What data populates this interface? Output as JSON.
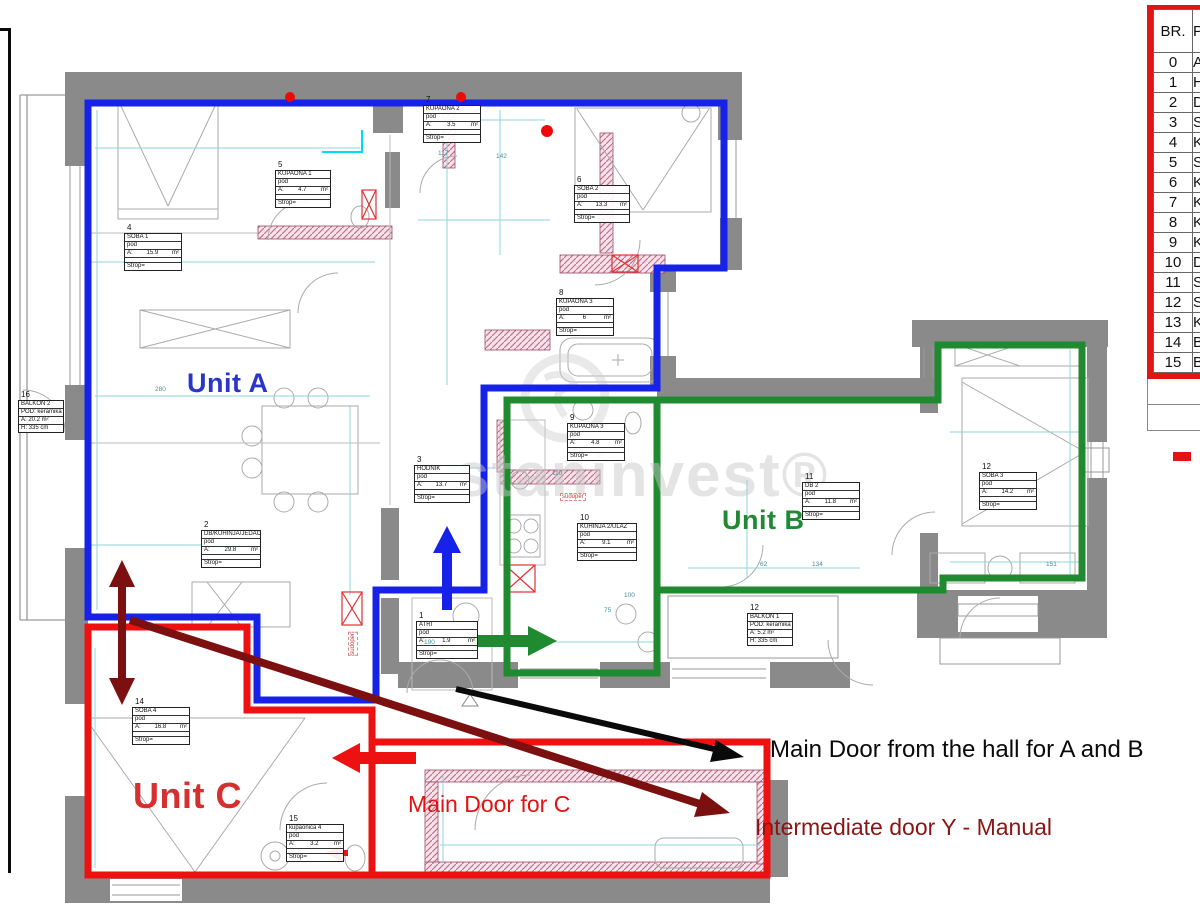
{
  "annotations": {
    "unit_a": "Unit A",
    "unit_b": "Unit B",
    "unit_c": "Unit C",
    "main_door_ab": "Main Door from the hall for A and B",
    "main_door_c": "Main Door for C",
    "intermediate_door": "Intermediate door Y - Manual"
  },
  "watermark": "staninvest®",
  "colors": {
    "unit_a_outline": "#1722e8",
    "unit_b_outline": "#1f8a2f",
    "unit_c_outline": "#ee1111",
    "unit_a_text": "#2a35c9",
    "unit_b_text": "#1f8a33",
    "unit_c_text": "#d53030",
    "main_door_c_text": "#e31212",
    "intermediate_text": "#8b1515",
    "maroon_arrow": "#7c1010",
    "wall_gray": "#8a8a8a"
  },
  "plan": {
    "rooms": [
      {
        "num": "1",
        "title": "ATRI",
        "pod": "pod",
        "area": "1.9",
        "strop": "Strop=",
        "x": 416,
        "y": 612,
        "w": 62
      },
      {
        "num": "2",
        "title": "DB/KUHINJA/JEDAĆA",
        "pod": "pod",
        "area": "29.8",
        "strop": "Strop=",
        "x": 201,
        "y": 521,
        "w": 60
      },
      {
        "num": "3",
        "title": "HODNIK",
        "pod": "pod",
        "area": "13.7",
        "strop": "Strop=",
        "x": 414,
        "y": 456,
        "w": 56
      },
      {
        "num": "4",
        "title": "SOBA 1",
        "pod": "pod",
        "area": "15.9",
        "strop": "Strop=",
        "x": 124,
        "y": 224,
        "w": 58
      },
      {
        "num": "5",
        "title": "KUPAONA 1",
        "pod": "pod",
        "area": "4.7",
        "strop": "Strop=",
        "x": 275,
        "y": 161,
        "w": 56
      },
      {
        "num": "6",
        "title": "SOBA 2",
        "pod": "pod",
        "area": "13.3",
        "strop": "Strop=",
        "x": 574,
        "y": 176,
        "w": 56
      },
      {
        "num": "7",
        "title": "KUPAONA 2",
        "pod": "pod",
        "area": "3.5",
        "strop": "Strop=",
        "x": 423,
        "y": 96,
        "w": 58
      },
      {
        "num": "8",
        "title": "KUPAONA 3",
        "pod": "pod",
        "area": "6",
        "strop": "Strop=",
        "x": 556,
        "y": 289,
        "w": 58
      },
      {
        "num": "9",
        "title": "KUPAONA 3",
        "pod": "pod",
        "area": "4.8",
        "strop": "Strop=",
        "x": 567,
        "y": 414,
        "w": 58
      },
      {
        "num": "10",
        "title": "KUHINJA 2/ULAZ",
        "pod": "pod",
        "area": "9.1",
        "strop": "Strop=",
        "x": 577,
        "y": 514,
        "w": 60
      },
      {
        "num": "11",
        "title": "DB 2",
        "pod": "pod",
        "area": "11.8",
        "strop": "Strop=",
        "x": 802,
        "y": 473,
        "w": 58
      },
      {
        "num": "12",
        "title": "SOBA 3",
        "pod": "pod",
        "area": "14.2",
        "strop": "Strop=",
        "x": 979,
        "y": 463,
        "w": 58
      },
      {
        "num": "14",
        "title": "SOBA 4",
        "pod": "pod",
        "area": "16.8",
        "strop": "Strop=",
        "x": 132,
        "y": 698,
        "w": 58
      },
      {
        "num": "15",
        "title": "kupaonica 4",
        "pod": "pod",
        "area": "3.2",
        "strop": "Strop=",
        "x": 286,
        "y": 815,
        "w": 58
      }
    ],
    "balconies": [
      {
        "num": "16",
        "title": "BALKON 2",
        "rows": [
          "POD: keramika",
          "A: 20.2  m²",
          "H: 335  cm"
        ],
        "x": 18,
        "y": 391,
        "w": 46
      },
      {
        "num": "12",
        "title": "BALKON 1",
        "rows": [
          "POD: keramika",
          "A: 5.2  m²",
          "H: 335  cm"
        ],
        "x": 747,
        "y": 604,
        "w": 46
      }
    ],
    "area_prefix": "A:",
    "area_unit": "m²",
    "dim_labels": [
      {
        "t": "280",
        "x": 155,
        "y": 386
      },
      {
        "t": "117",
        "x": 438,
        "y": 150
      },
      {
        "t": "142",
        "x": 496,
        "y": 153
      },
      {
        "t": "190",
        "x": 424,
        "y": 639
      },
      {
        "t": "100",
        "x": 624,
        "y": 592
      },
      {
        "t": "75",
        "x": 604,
        "y": 607
      },
      {
        "t": "62",
        "x": 760,
        "y": 561
      },
      {
        "t": "134",
        "x": 812,
        "y": 561
      },
      {
        "t": "151",
        "x": 1046,
        "y": 561
      },
      {
        "t": "110",
        "x": 552,
        "y": 470
      }
    ],
    "micro_labels": [
      {
        "t": "sudoper",
        "x": 560,
        "y": 493,
        "vert": false
      },
      {
        "t": "sudoper",
        "x": 348,
        "y": 632,
        "vert": true
      }
    ]
  },
  "legend_table": {
    "headers": [
      "BR.",
      "P"
    ],
    "rows": [
      [
        "0",
        "A"
      ],
      [
        "1",
        "H"
      ],
      [
        "2",
        "D"
      ],
      [
        "3",
        "S"
      ],
      [
        "4",
        "K"
      ],
      [
        "5",
        "S"
      ],
      [
        "6",
        "K"
      ],
      [
        "7",
        "K"
      ],
      [
        "8",
        "K"
      ],
      [
        "9",
        "K"
      ],
      [
        "10",
        "D"
      ],
      [
        "11",
        "S"
      ],
      [
        "12",
        "S"
      ],
      [
        "13",
        "K"
      ],
      [
        "14",
        "B"
      ],
      [
        "15",
        "B"
      ]
    ]
  }
}
